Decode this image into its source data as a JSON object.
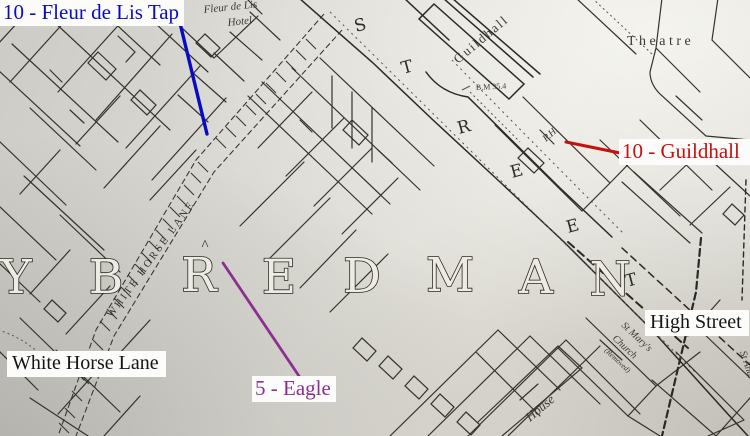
{
  "annotations": {
    "fleur": {
      "label": "10 - Fleur de Lis Tap",
      "color": "#0a0ac4"
    },
    "guildhall": {
      "label": "10 - Guildhall",
      "color": "#c60f0f"
    },
    "eagle": {
      "label": "5 - Eagle",
      "color": "#8e2d92"
    },
    "white_horse_lane": {
      "label": "White Horse Lane",
      "color": "#151515"
    },
    "high_street": {
      "label": "High Street",
      "color": "#151515"
    }
  },
  "map_texts": {
    "hotel_line1": "Fleur de Lis",
    "hotel_line2": "Hotel",
    "guildhall": "Guildhall",
    "theatre": "Theatre",
    "bench_mark": "B.M 35.4",
    "public_house": "P.H.",
    "street_letters": [
      "S",
      "T",
      "R",
      "E",
      "E",
      "T"
    ],
    "parish_letters": [
      "Y",
      "B",
      "R",
      "E",
      "D",
      "M",
      "A",
      "N"
    ],
    "caret_mark": "^",
    "lane_name": "WHITE HORSE LANE",
    "church_line1": "St Mary's",
    "church_line2": "Church",
    "church_line3": "(Removed)",
    "house": "House",
    "edge_street_partial": "St Andr"
  }
}
